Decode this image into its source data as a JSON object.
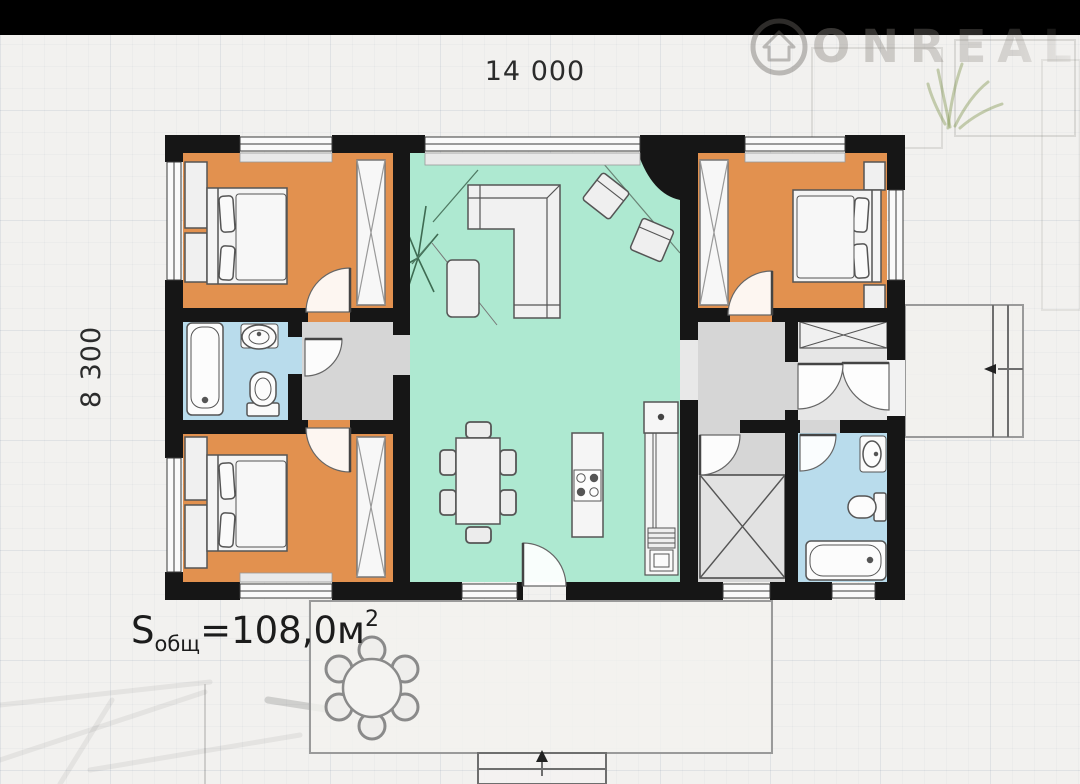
{
  "watermark": {
    "brand": "ONREAL",
    "icon": "house-in-circle-icon"
  },
  "dimensions": {
    "top": "14 000",
    "left": "8 300"
  },
  "area_label": {
    "prefix": "S",
    "subscript": "общ",
    "value": "=108,0м",
    "superscript": "2"
  },
  "colors": {
    "wall": "#161616",
    "bedroom": "#e2914f",
    "living": "#aee9d1",
    "bathroom": "#b9dcec",
    "hall": "#d6d6d6",
    "closet": "#e6e6e6",
    "passage": "#e8e8e8",
    "terrace": "#f3f2ef",
    "paper": "#f2f1ef",
    "black_bar": "#000000"
  }
}
